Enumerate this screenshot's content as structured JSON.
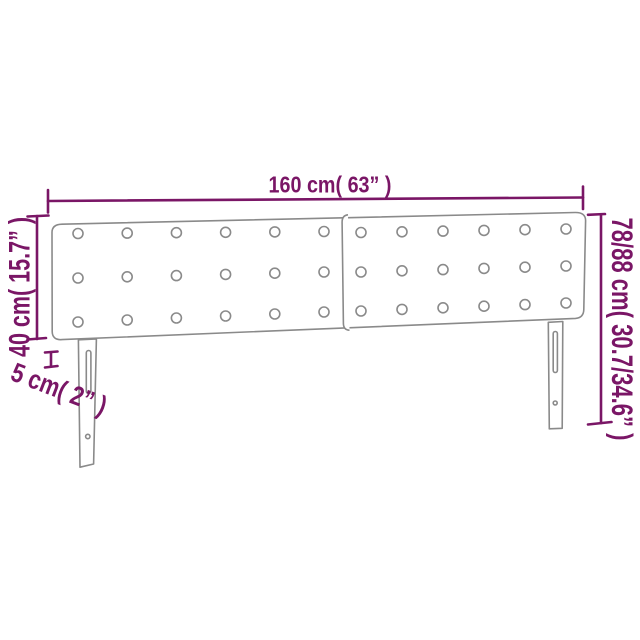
{
  "diagram": {
    "product": "upholstered-headboard-with-legs",
    "colors": {
      "dimension": "#7A1666",
      "outline": "#8A8A8A",
      "background": "#FFFFFF"
    },
    "labels": {
      "width": "160 cm( 63” )",
      "panel_height": "40 cm( 15.7” )",
      "thickness": "5 cm( 2” )",
      "total_height": "78/88 cm( 30.7/34.6” )"
    },
    "values": {
      "width_cm": 160,
      "width_in": 63,
      "panel_height_cm": 40,
      "panel_height_in": 15.7,
      "thickness_cm": 5,
      "thickness_in": 2,
      "total_height_cm_min": 78,
      "total_height_cm_max": 88,
      "total_height_in_min": 30.7,
      "total_height_in_max": 34.6
    },
    "headboard": {
      "panel_count": 2,
      "buttons": {
        "rows": 3,
        "cols": 6
      },
      "legs": 2
    }
  }
}
